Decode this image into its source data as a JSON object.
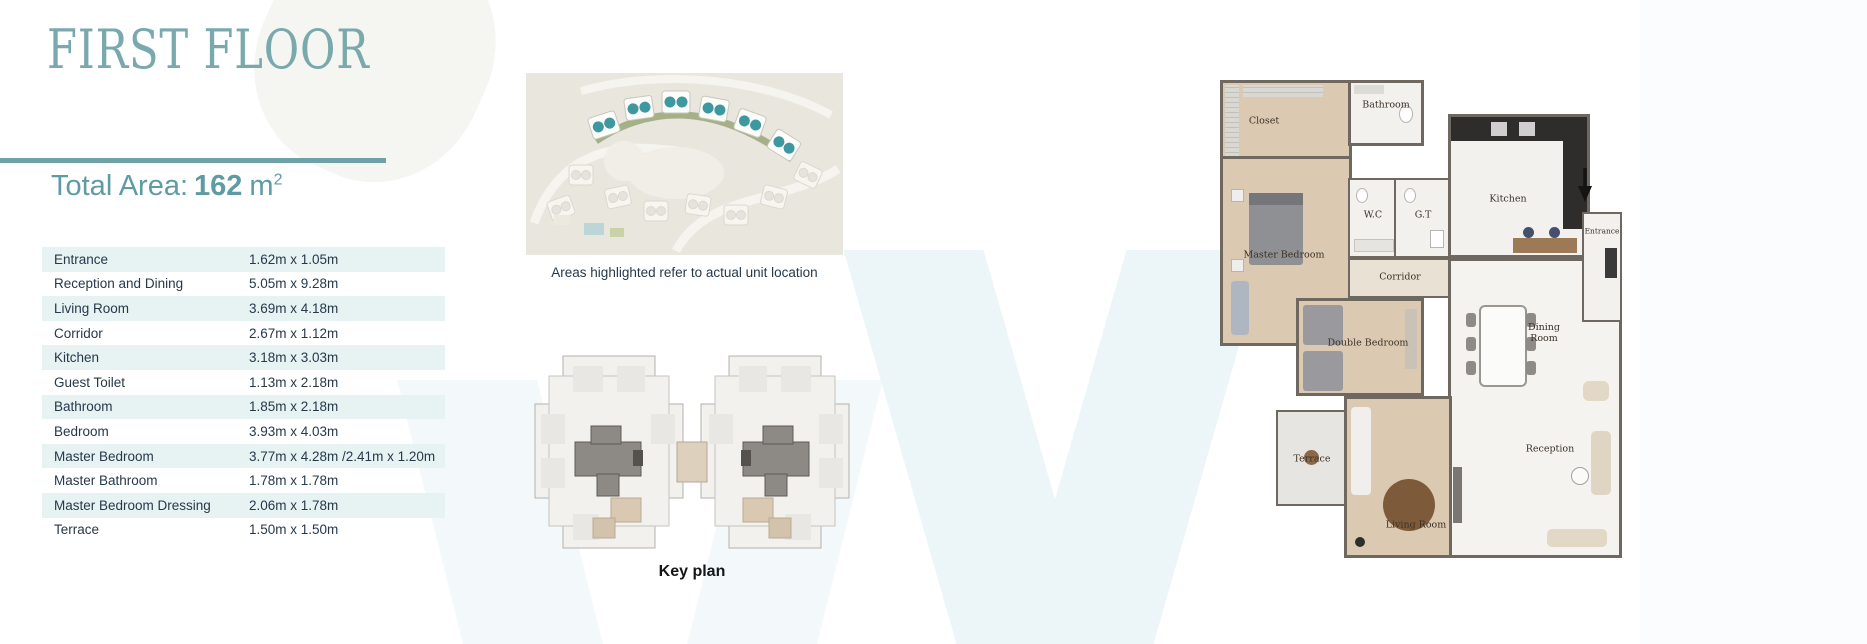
{
  "page": {
    "title": "FIRST FLOOR",
    "total_area": {
      "label": "Total Area:",
      "value": "162",
      "unit": "m",
      "exponent": "2"
    }
  },
  "dimensions_table": {
    "rows": [
      {
        "room": "Entrance",
        "size": "1.62m x 1.05m"
      },
      {
        "room": "Reception and Dining",
        "size": "5.05m x 9.28m"
      },
      {
        "room": "Living Room",
        "size": "3.69m x 4.18m"
      },
      {
        "room": "Corridor",
        "size": "2.67m x 1.12m"
      },
      {
        "room": "Kitchen",
        "size": "3.18m x 3.03m"
      },
      {
        "room": "Guest Toilet",
        "size": "1.13m x 2.18m"
      },
      {
        "room": "Bathroom",
        "size": "1.85m x 2.18m"
      },
      {
        "room": "Bedroom",
        "size": "3.93m x 4.03m"
      },
      {
        "room": "Master Bedroom",
        "size": "3.77m x 4.28m /2.41m x 1.20m"
      },
      {
        "room": "Master Bathroom",
        "size": "1.78m x 1.78m"
      },
      {
        "room": "Master Bedroom Dressing",
        "size": "2.06m x 1.78m"
      },
      {
        "room": "Terrace",
        "size": "1.50m x 1.50m"
      }
    ]
  },
  "site_plan": {
    "caption": "Areas highlighted refer to actual unit location"
  },
  "key_plan": {
    "caption": "Key plan"
  },
  "floor_plan": {
    "icons": {
      "entrance_arrow": "arrow-down"
    },
    "rooms": {
      "closet": "Closet",
      "bathroom": "Bathroom",
      "wc": "W.C",
      "gt": "G.T",
      "kitchen": "Kitchen",
      "entrance": "Entrance",
      "master_bedroom": "Master Bedroom",
      "corridor": "Corridor",
      "double_bedroom": "Double Bedroom",
      "dining_room": "Dining Room",
      "terrace": "Terrace",
      "living_room": "Living Room",
      "reception": "Reception"
    }
  },
  "colors": {
    "accent_teal": "#6fa1a6",
    "title_teal": "#7aa9ad",
    "table_shade": "#e7f2f3",
    "body_text": "#26394a",
    "plan_wall": "#6e6861",
    "floor_beige": "#dcc9b2",
    "kitchen_dark": "#2e2d2b",
    "highlighted_unit_teal": "#3d98a0"
  }
}
